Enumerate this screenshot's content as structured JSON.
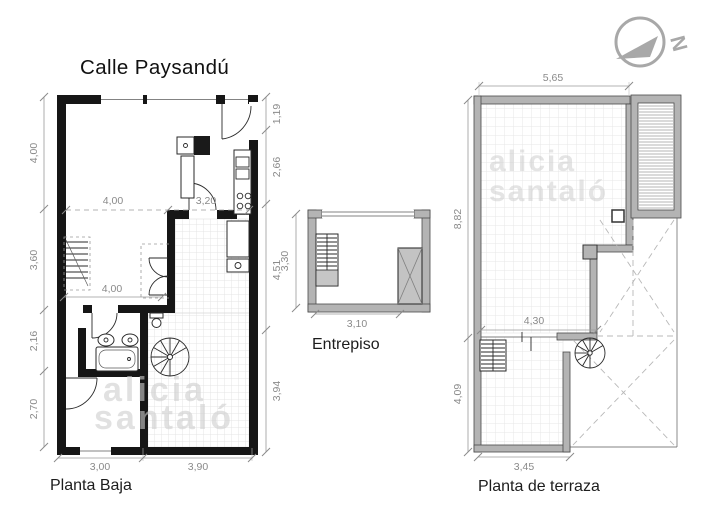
{
  "title": "Calle Paysandú",
  "north": {
    "label": "N"
  },
  "watermark": {
    "line1": "alicia",
    "line2": "santaló"
  },
  "planta_baja": {
    "label": "Planta Baja",
    "dims": {
      "left": [
        "4,00",
        "3,60",
        "2,16",
        "2,70"
      ],
      "right": [
        "1,19",
        "2,66",
        "4,51",
        "3,94"
      ],
      "bottom": [
        "3,00",
        "3,90"
      ],
      "interior_top_left": "4,00",
      "interior_top_right": "3,20",
      "interior_mid": "4,00"
    }
  },
  "entrepiso": {
    "label": "Entrepiso",
    "dims": {
      "left": "3,30",
      "bottom": "3,10"
    }
  },
  "terraza": {
    "label": "Planta de terraza",
    "dims": {
      "top": "5,65",
      "left_upper": "8,82",
      "left_lower": "4,09",
      "interior": "4,30",
      "bottom": "3,45"
    }
  },
  "colors": {
    "wall_black": "#161616",
    "wall_gray": "#b4b4b4",
    "dim": "#8d8d8d",
    "watermark": "#cecece",
    "north": "#a8a8a8"
  }
}
